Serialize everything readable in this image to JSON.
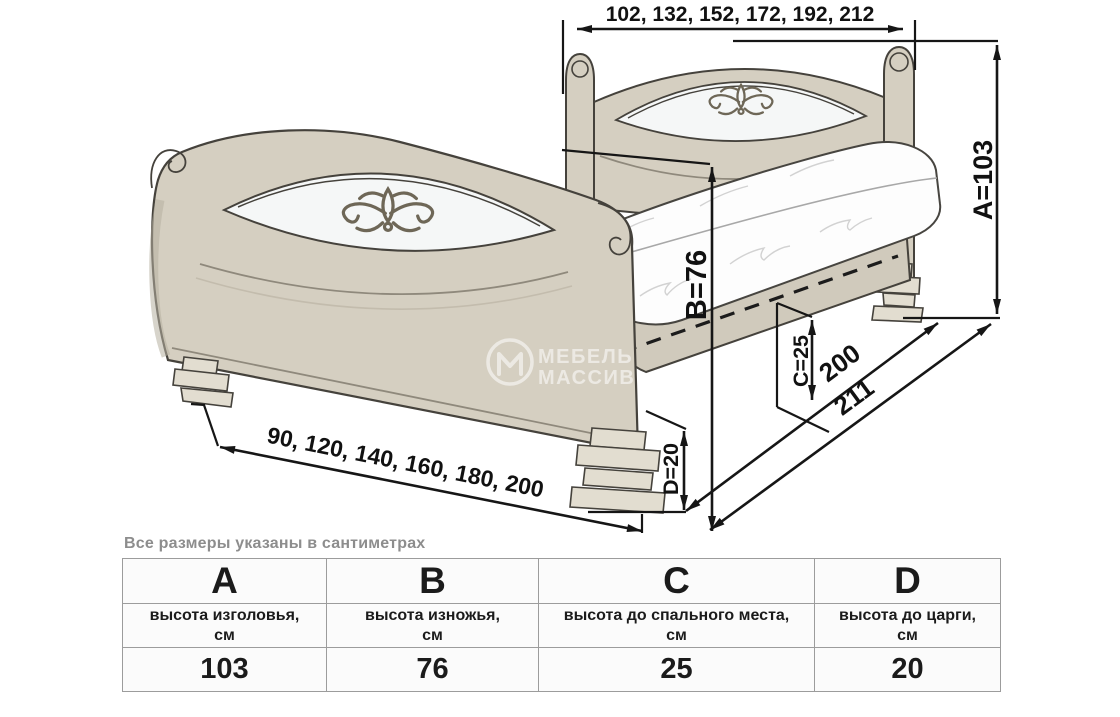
{
  "note": "Все размеры указаны в сантиметрах",
  "watermark": {
    "line1": "МЕБЕЛЬ",
    "line2": "МАССИВ"
  },
  "diagram": {
    "labels": {
      "headboard_widths": "102, 132, 152, 172, 192, 212",
      "footboard_widths": "90, 120, 140, 160, 180, 200",
      "height_a": "A=103",
      "height_b": "B=76",
      "height_c": "C=25",
      "height_d": "D=20",
      "mattress_length": "200",
      "total_length": "211"
    },
    "colors": {
      "wood": "#d5cfc1",
      "wood_shadow": "#b7b0a1",
      "leg": "#e2ddd0",
      "outline": "#45423c",
      "dimension_line": "#161616",
      "ornament": "#6e6757",
      "lens_cutout": "#f5f7f7",
      "table_border": "#9c9c9c",
      "note_text": "#8d8d8d"
    }
  },
  "table": {
    "columns": [
      {
        "letter": "A",
        "description": "высота изголовья,",
        "unit": "см",
        "value": "103"
      },
      {
        "letter": "B",
        "description": "высота изножья,",
        "unit": "см",
        "value": "76"
      },
      {
        "letter": "C",
        "description": "высота до спального места,",
        "unit": "см",
        "value": "25"
      },
      {
        "letter": "D",
        "description": "высота до царги,",
        "unit": "см",
        "value": "20"
      }
    ]
  }
}
